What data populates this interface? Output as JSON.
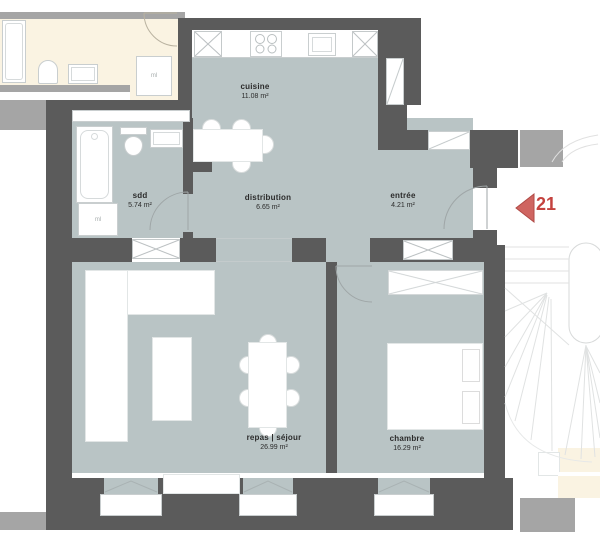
{
  "plan": {
    "unit_marker": "21",
    "rooms": {
      "cuisine": {
        "name": "cuisine",
        "area": "11.08 m²"
      },
      "sdd": {
        "name": "sdd",
        "area": "5.74 m²"
      },
      "distribution": {
        "name": "distribution",
        "area": "6.65 m²"
      },
      "entree": {
        "name": "entrée",
        "area": "4.21 m²"
      },
      "repas_sejour": {
        "name": "repas | séjour",
        "area": "26.99 m²"
      },
      "chambre": {
        "name": "chambre",
        "area": "16.29 m²"
      }
    },
    "appliances": {
      "washing_machine_sdd": "ml",
      "washing_machine_neighbor": "ml"
    },
    "colors": {
      "floor": "#b9c4c5",
      "wall_dark": "#5b5b5b",
      "wall_neighbor": "#a5a5a5",
      "neighbor_floor": "#faf3e2",
      "marker_arrow_fill": "#cf6561",
      "marker_arrow_stroke": "#b04a46",
      "marker_text": "#c4423e"
    }
  }
}
